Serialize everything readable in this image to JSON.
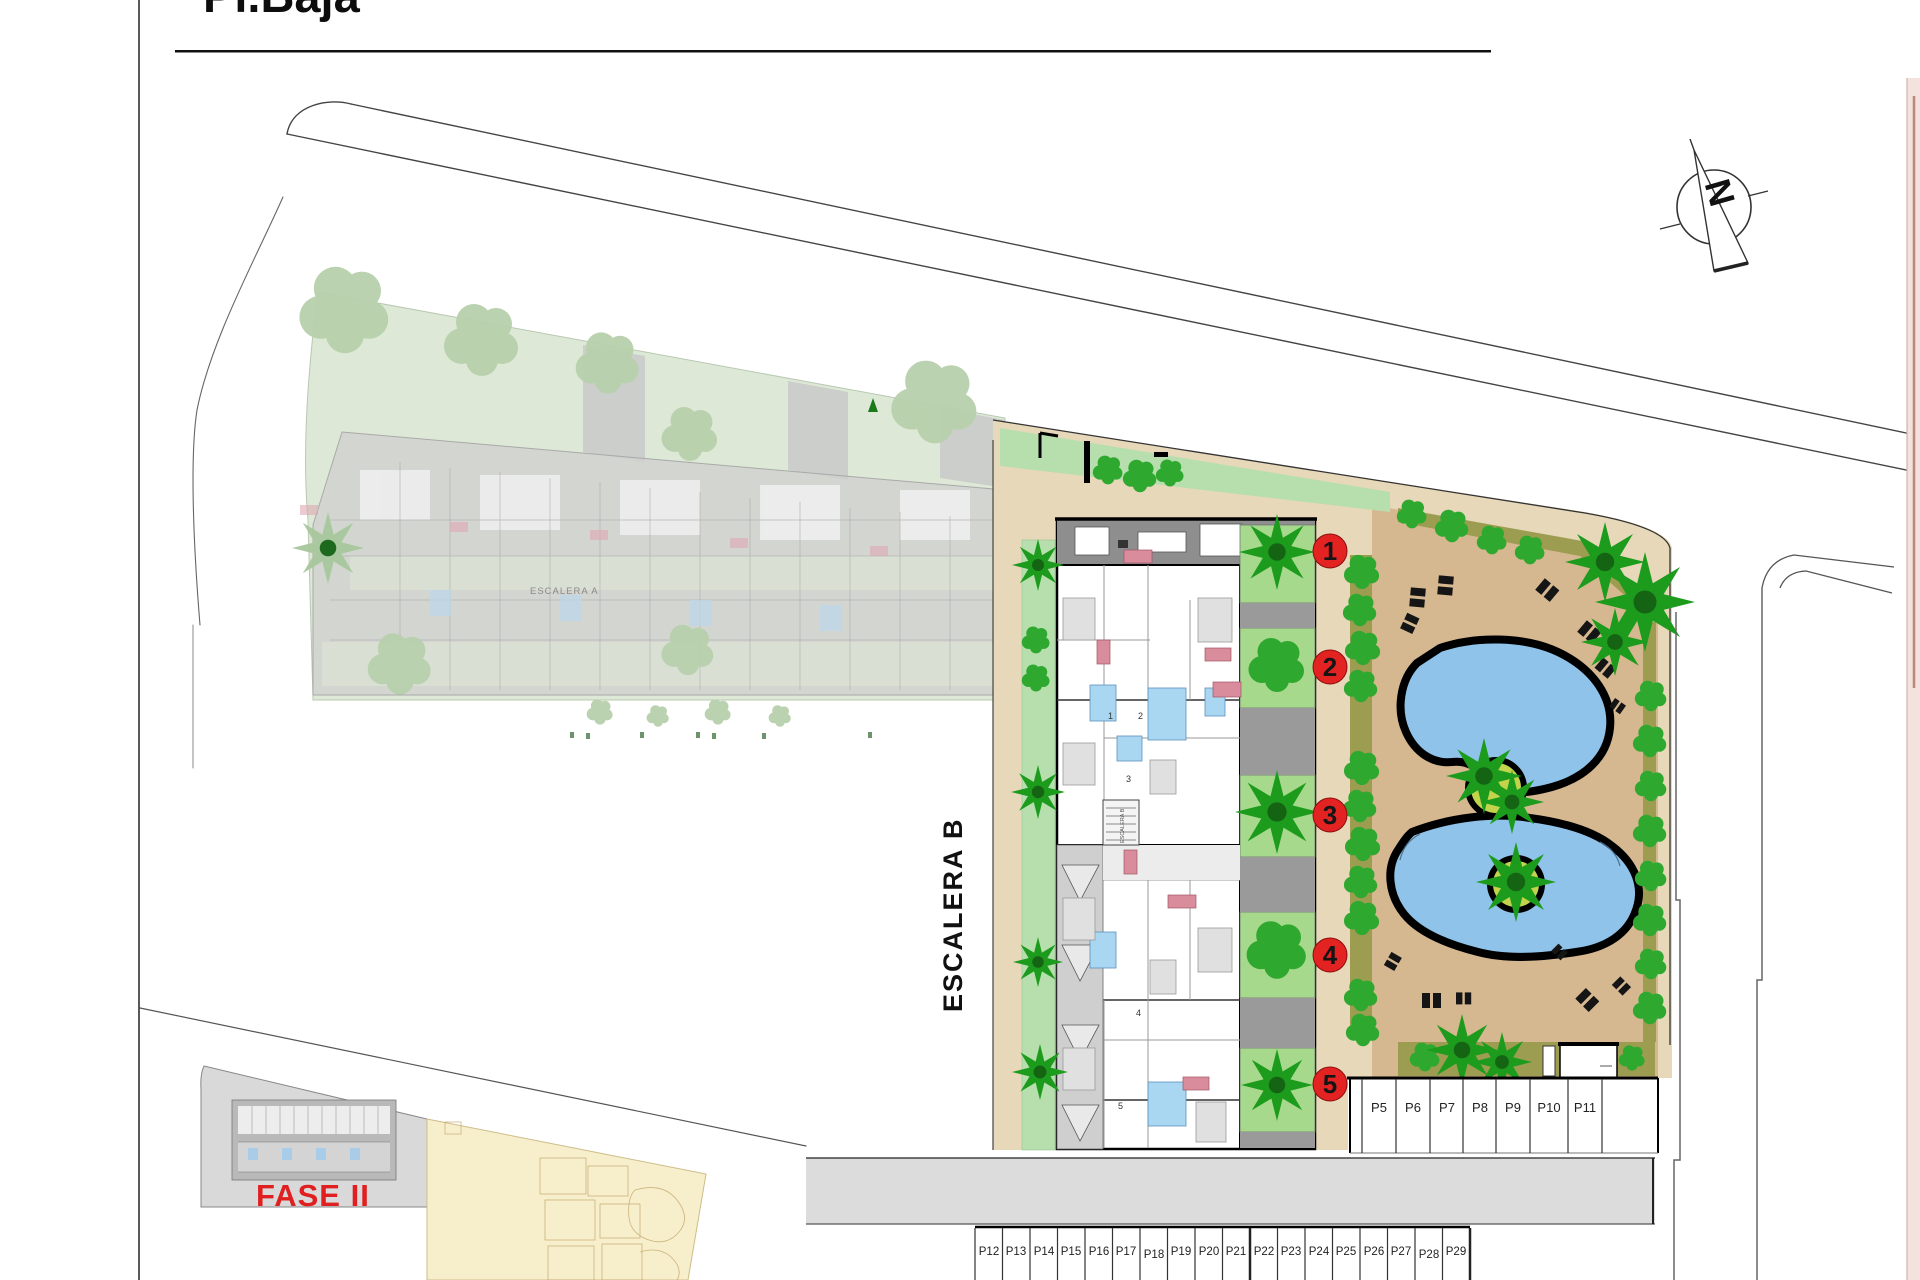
{
  "page": {
    "title": "Pl.Baja"
  },
  "compass": {
    "label": "N"
  },
  "plan": {
    "escalera_b_label": "ESCALERA B",
    "escalera_a_label": "ESCALERA A",
    "stairwell_label": "ESCALERA B",
    "fase2_label": "FASE II",
    "unit_markers": [
      "1",
      "2",
      "3",
      "4",
      "5"
    ]
  },
  "markers": {
    "circled": [
      "1",
      "2",
      "3",
      "4",
      "5"
    ]
  },
  "parking": {
    "row_top_labels": [
      "P5",
      "P6",
      "P7",
      "P8",
      "P9",
      "P10",
      "P11"
    ],
    "row_bottom_labels": [
      "P12",
      "P13",
      "P14",
      "P15",
      "P16",
      "P17",
      "P18",
      "P19",
      "P20",
      "P21",
      "P22",
      "P23",
      "P24",
      "P25",
      "P26",
      "P27",
      "P28",
      "P29"
    ]
  },
  "colors": {
    "marker_red": "#e32222",
    "fase2_red": "#e02020",
    "pool_blue": "#8fc3ea",
    "deck_tan": "#d5b890",
    "walkway_tan": "#e7d8ba",
    "hedge_olive": "#9d9d52",
    "plant_green": "#2fa82f",
    "palm_green": "#1d9b1d",
    "lawn_green": "#b7dfae",
    "unit_garden_green": "#a6d98c",
    "faded_site_green": "#dde9d6",
    "fase2_plot_grey": "#d9d9d9",
    "fase3_plot_yellow": "#f7eecb",
    "road_grey": "#dcdcdc"
  }
}
